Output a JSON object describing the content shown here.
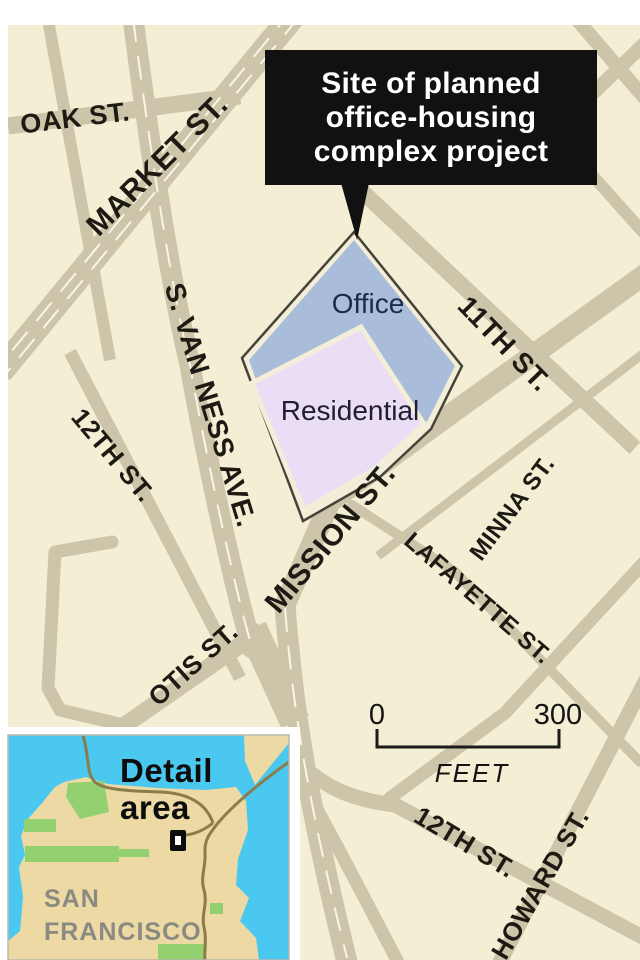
{
  "callout": {
    "lines": [
      "Site of planned",
      "office-housing",
      "complex project"
    ],
    "bg_color": "#111111",
    "text_color": "#ffffff"
  },
  "site": {
    "office_label": "Office",
    "residential_label": "Residential",
    "office_color": "#a9bdda",
    "residential_color": "#e9def6",
    "outline_color": "#45433a"
  },
  "streets": {
    "oak": "OAK ST.",
    "market": "MARKET ST.",
    "s_van_ness": "S. VAN NESS AVE.",
    "twelfth_upper": "12TH ST.",
    "otis": "OTIS ST.",
    "mission": "MISSION ST.",
    "eleventh": "11TH ST.",
    "minna": "MINNA ST.",
    "lafayette": "LAFAYETTE ST.",
    "howard": "HOWARD ST.",
    "twelfth_lower": "12TH ST."
  },
  "scale_bar": {
    "start": "0",
    "end": "300",
    "unit": "FEET"
  },
  "inset": {
    "title_line1": "Detail",
    "title_line2": "area",
    "city_line1": "SAN",
    "city_line2": "FRANCISCO",
    "water_color": "#4ac8f0",
    "land_color": "#ecd9a4",
    "park_color": "#93d170",
    "road_color": "#8b7d4b"
  },
  "map": {
    "background": "#f4eed5",
    "street_color": "#cdc5a9",
    "label_color": "#1c1a12"
  }
}
